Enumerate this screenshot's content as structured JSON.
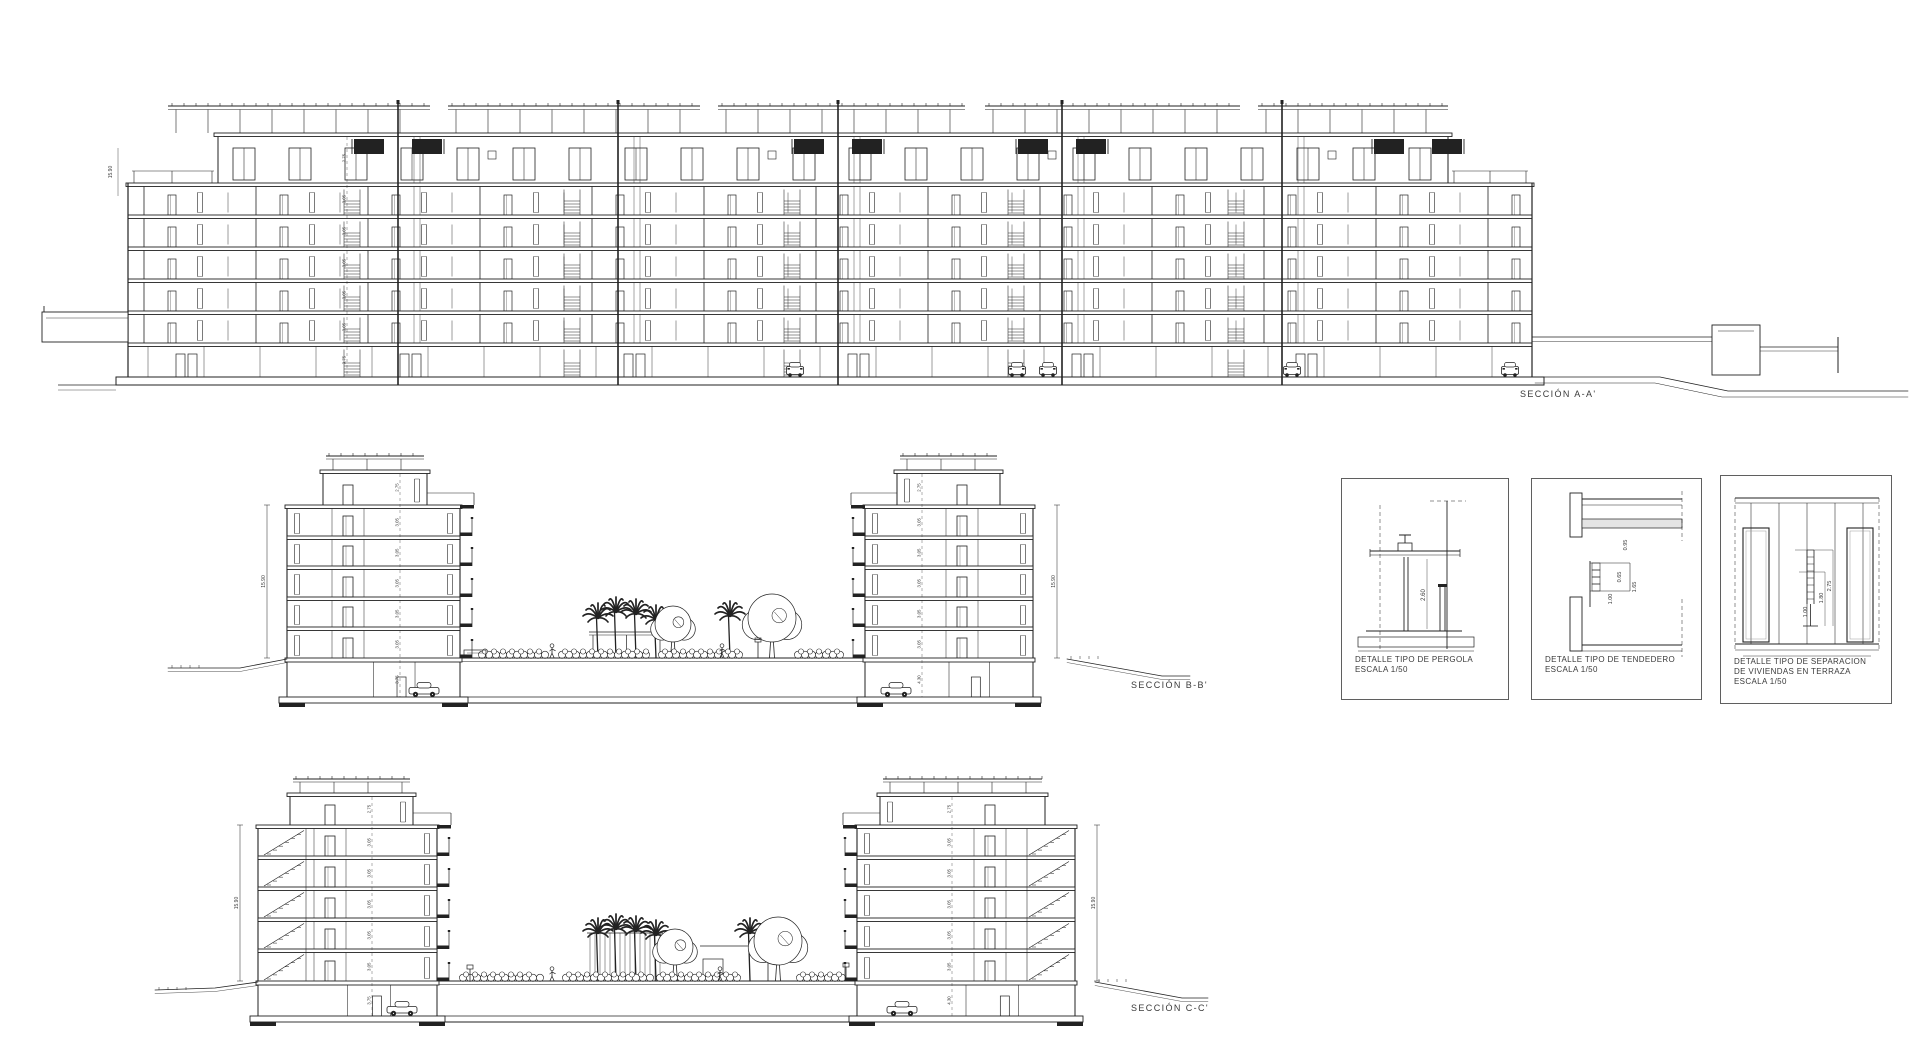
{
  "page": {
    "background": "#ffffff",
    "ink": "#222222"
  },
  "sections": {
    "a": {
      "label": "SECCIÓN A-A'"
    },
    "b": {
      "label": "SECCIÓN B-B'"
    },
    "c": {
      "label": "SECCIÓN C-C'"
    }
  },
  "dims": {
    "total": "15.90",
    "floor": "3.05",
    "penthouse": "2.75",
    "garage_a": "3.75",
    "garage_deep": "4.30"
  },
  "details": [
    {
      "line1": "DETALLE TIPO DE PERGOLA",
      "line2": "ESCALA 1/50",
      "dims": [
        "2.60"
      ]
    },
    {
      "line1": "DETALLE TIPO DE TENDEDERO",
      "line2": "ESCALA 1/50",
      "dims": [
        "0.95",
        "0.65",
        "1.65",
        "1.00"
      ]
    },
    {
      "line1": "DETALLE TIPO DE SEPARACION",
      "line2": "DE VIVIENDAS EN TERRAZA",
      "line3": "ESCALA 1/50",
      "dims": [
        "2.75",
        "1.80",
        "1.00"
      ]
    }
  ],
  "geometry": {
    "sectionA": {
      "x0": 128,
      "x1": 1532,
      "yPhRoof": 133,
      "yMainRoof": 183,
      "floorSlabs": [
        215,
        247,
        279,
        311,
        343
      ],
      "yGarageBot": 377,
      "yBase": 385,
      "ph": {
        "x0": 218,
        "x1": 1448
      },
      "secLines": [
        398,
        618,
        838,
        1062,
        1282
      ],
      "blackPairs": [
        398,
        838,
        1062,
        1418
      ],
      "pergolaSegs": [
        [
          168,
          430
        ],
        [
          448,
          700
        ],
        [
          718,
          965
        ],
        [
          985,
          1240
        ],
        [
          1258,
          1448
        ]
      ],
      "cars": [
        795,
        1017,
        1048,
        1292,
        1510
      ],
      "dimCol": {
        "x": 347,
        "rows": [
          [
            158,
            "2.75"
          ],
          [
            199,
            "3.05"
          ],
          [
            231,
            "3.05"
          ],
          [
            263,
            "3.05"
          ],
          [
            295,
            "3.05"
          ],
          [
            327,
            "3.05"
          ],
          [
            360,
            "3.75"
          ]
        ]
      },
      "elevText": {
        "x": 112,
        "y": 172,
        "v": "15.90"
      }
    },
    "towers": {
      "b": {
        "yPerg": 456,
        "yPh": 470,
        "yRoof": 505,
        "slabs": [
          536,
          566,
          597,
          627
        ],
        "yDeck": 658,
        "yBFloor": 697
      },
      "c": {
        "yPerg": 779,
        "yPh": 793,
        "yRoof": 825,
        "slabs": [
          856,
          887,
          918,
          949
        ],
        "yDeck": 981,
        "yBFloor": 1016
      }
    },
    "towerList": [
      {
        "lv": "b",
        "x0": 287,
        "x1": 460,
        "ph": [
          323,
          427
        ],
        "balc": "R",
        "dimX": 267,
        "car": 424,
        "doorX": 348,
        "dimColX": 400,
        "stairs": null,
        "bsmt": "3.75"
      },
      {
        "lv": "b",
        "x0": 865,
        "x1": 1033,
        "ph": [
          897,
          1000
        ],
        "balc": "L",
        "dimX": 1057,
        "car": 896,
        "doorX": 962,
        "dimColX": 922,
        "stairs": null,
        "bsmt": "4.30"
      },
      {
        "lv": "c",
        "x0": 258,
        "x1": 437,
        "ph": [
          290,
          413
        ],
        "balc": "R",
        "dimX": 240,
        "car": 402,
        "doorX": 330,
        "dimColX": 372,
        "stairs": "L",
        "bsmt": "3.75"
      },
      {
        "lv": "c",
        "x0": 857,
        "x1": 1075,
        "ph": [
          880,
          1045
        ],
        "balc": "L",
        "dimX": 1097,
        "car": 902,
        "doorX": 990,
        "dimColX": 952,
        "stairs": "R",
        "bsmt": "4.30"
      }
    ],
    "courtyards": [
      {
        "lv": "b",
        "x0": 460,
        "x1": 865,
        "palms": [
          [
            598,
            40
          ],
          [
            616,
            46
          ],
          [
            636,
            44
          ],
          [
            656,
            38
          ],
          [
            730,
            42
          ]
        ],
        "trees": [
          [
            673,
            18
          ],
          [
            772,
            24
          ]
        ],
        "shrubs": [
          [
            482,
            548
          ],
          [
            562,
            652
          ],
          [
            662,
            740
          ],
          [
            798,
            840
          ]
        ],
        "persons": [
          552,
          722
        ],
        "pergolaPosts": [
          593,
          660
        ],
        "planter": [
          464,
          486
        ],
        "lamps": [
          [
            758,
            16
          ]
        ]
      },
      {
        "lv": "c",
        "x0": 437,
        "x1": 857,
        "palms": [
          [
            598,
            48
          ],
          [
            616,
            52
          ],
          [
            636,
            50
          ],
          [
            656,
            46
          ],
          [
            750,
            48
          ]
        ],
        "trees": [
          [
            675,
            18
          ],
          [
            778,
            24
          ]
        ],
        "shrubs": [
          [
            463,
            540
          ],
          [
            566,
            652
          ],
          [
            660,
            742
          ],
          [
            800,
            845
          ]
        ],
        "persons": [
          552,
          720
        ],
        "screen": [
          590,
          660
        ],
        "structure": [
          703,
          730
        ],
        "lamps": [
          [
            470,
            12
          ],
          [
            846,
            14
          ]
        ]
      }
    ],
    "terrain": {
      "b_left": [
        [
          168,
          668
        ],
        [
          240,
          668
        ],
        [
          287,
          659
        ]
      ],
      "b_right": [
        [
          1067,
          659
        ],
        [
          1162,
          676
        ],
        [
          1190,
          676
        ]
      ],
      "c_left": [
        [
          155,
          990
        ],
        [
          215,
          988
        ],
        [
          258,
          982
        ]
      ],
      "c_right": [
        [
          1095,
          982
        ],
        [
          1182,
          998
        ],
        [
          1208,
          998
        ]
      ]
    }
  }
}
